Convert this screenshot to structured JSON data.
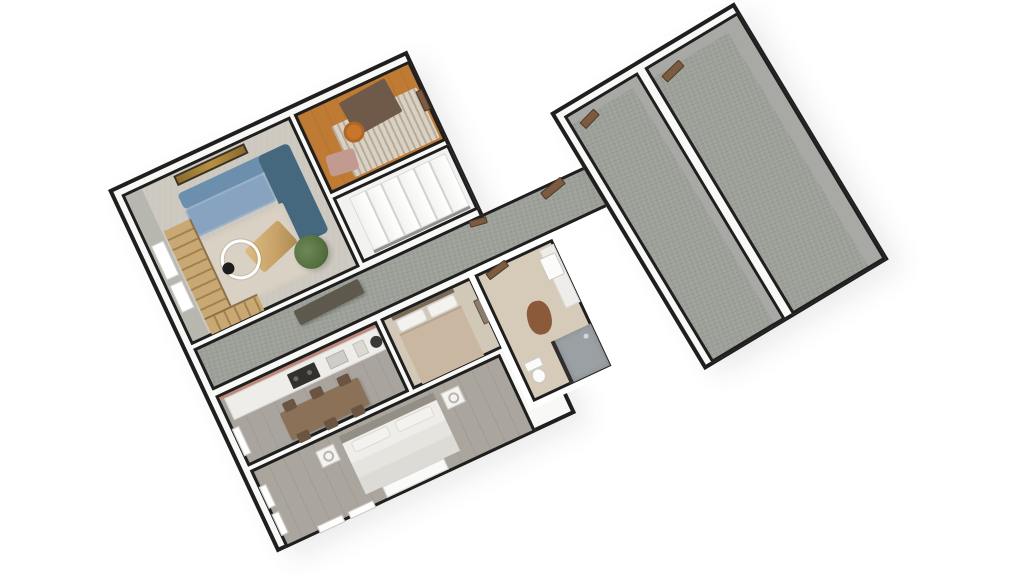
{
  "view": {
    "type": "3d-dollhouse-floorplan",
    "background": "#ffffff"
  },
  "palette": {
    "bg": "#ffffff",
    "wall_line": "#1f1f1f",
    "wall_fill": "#f8f8f7",
    "wall_face_gray": "#a8a8a5",
    "living_floor": "#ccc8bf",
    "living_wall_face": "#b7b7af",
    "living_rug": "#d8d1c4",
    "office_floor": "#bf7a33",
    "office_rug": "#d9d1c3",
    "desk_brown": "#6f5a49",
    "stool_orange": "#c9752c",
    "cushion_pink": "#c39a90",
    "stairs_floor": "#f2f2f1",
    "corridor_carpet": "#9da099",
    "sideboard": "#5f584d",
    "kitchen_floor": "#a9a59e",
    "counter": "#eeede9",
    "stove": "#33312e",
    "accent_salmon": "#c08878",
    "dining_table": "#8a7158",
    "chair_brown": "#6b5542",
    "small_bed_floor": "#d2c8b8",
    "small_bed_duvet": "#c9b7a2",
    "bath_floor": "#d6cbb9",
    "shower_floor": "#9aa0a3",
    "mat_brown": "#8a5a3b",
    "master_floor": "#aaa59d",
    "bed_white": "#e6e4df",
    "lamp_white": "#f4f3f1",
    "sofa_light": "#87a3bf",
    "sofa_mid": "#6d8fae",
    "sofa_dark": "#45687f",
    "table_wood": "#c8a166",
    "plant_green": "#55713f",
    "art_gold": "#b9913f",
    "door_brown": "#7d5b41",
    "stair_wood": "#c9a873"
  },
  "floorplan": {
    "camera_marker": {
      "name": "360-camera-viewpoint"
    },
    "left_wing": {
      "rooms": [
        {
          "name": "living-room",
          "furniture": [
            "sectional-sofa",
            "coffee-table",
            "area-rug",
            "potted-plant",
            "wall-art",
            "open-wood-staircase",
            "windows",
            "camera-marker"
          ]
        },
        {
          "name": "office",
          "furniture": [
            "desk",
            "stool",
            "striped-rug",
            "floor-cushion",
            "door"
          ]
        },
        {
          "name": "stair-hall",
          "furniture": [
            "staircase",
            "door"
          ]
        },
        {
          "name": "hallway",
          "furniture": [
            "sideboard",
            "entry-door",
            "interior-door"
          ]
        },
        {
          "name": "kitchen-dining",
          "furniture": [
            "counter",
            "cooktop",
            "sink",
            "dining-table",
            "six-chairs",
            "window"
          ]
        },
        {
          "name": "small-bedroom",
          "furniture": [
            "bed",
            "pillows",
            "window"
          ]
        },
        {
          "name": "bathroom",
          "furniture": [
            "walk-in-shower",
            "toilet",
            "sink",
            "vanity",
            "bath-mat",
            "door"
          ]
        },
        {
          "name": "master-bedroom",
          "furniture": [
            "double-bed",
            "nightstand-left",
            "nightstand-right",
            "table-lamps",
            "bench",
            "windows"
          ]
        }
      ]
    },
    "right_wing": {
      "rooms": [
        {
          "name": "bonus-room-left",
          "furniture": [
            "door"
          ]
        },
        {
          "name": "bonus-room-right",
          "furniture": [
            "door"
          ]
        }
      ]
    }
  }
}
